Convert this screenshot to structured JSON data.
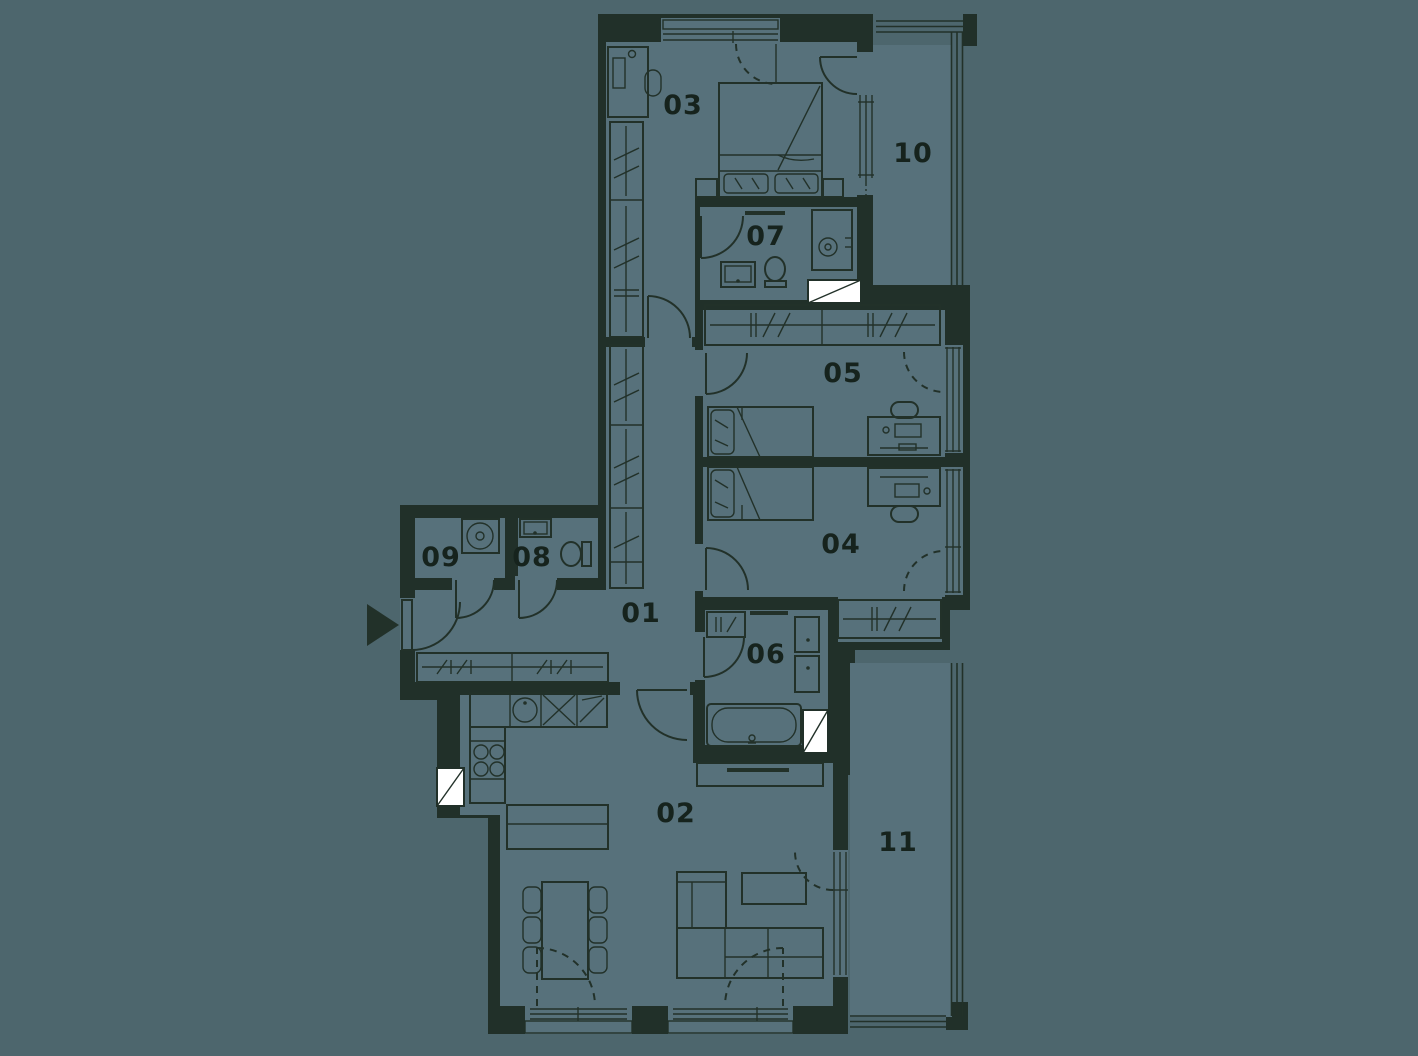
{
  "floor_plan": {
    "rooms": [
      {
        "id": "room-01",
        "label": "01"
      },
      {
        "id": "room-02",
        "label": "02"
      },
      {
        "id": "room-03",
        "label": "03"
      },
      {
        "id": "room-04",
        "label": "04"
      },
      {
        "id": "room-05",
        "label": "05"
      },
      {
        "id": "room-06",
        "label": "06"
      },
      {
        "id": "room-07",
        "label": "07"
      },
      {
        "id": "room-08",
        "label": "08"
      },
      {
        "id": "room-09",
        "label": "09"
      },
      {
        "id": "room-10",
        "label": "10"
      },
      {
        "id": "room-11",
        "label": "11"
      }
    ],
    "colors": {
      "background": "#4d666d",
      "floor": "#57717b",
      "walls": "#213029",
      "furniture_lines": "#223129",
      "labels": "#16231d",
      "shaft": "#ffffff"
    },
    "entrance_marker": "triangle-arrow"
  }
}
